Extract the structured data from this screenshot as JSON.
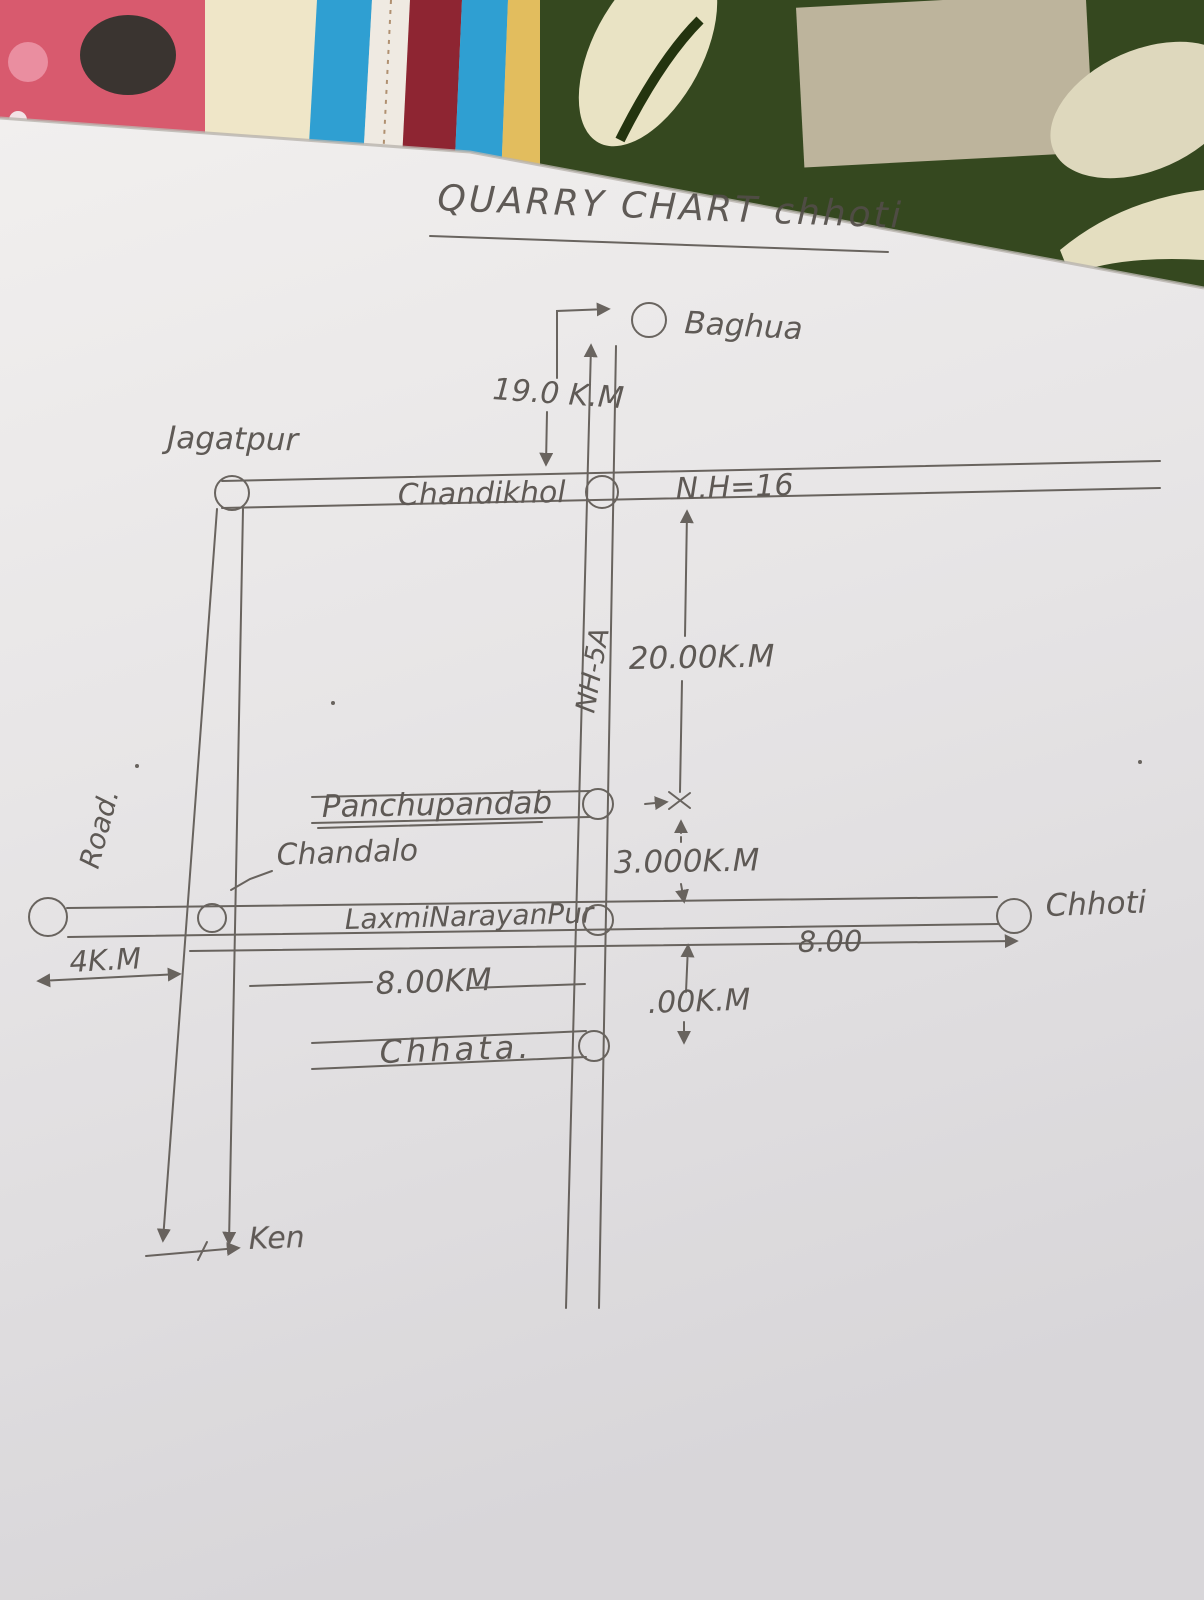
{
  "title": {
    "text": "QUARRY CHART chhoti"
  },
  "places": {
    "baghua": "Baghua",
    "jagatpur": "Jagatpur",
    "chandikhol": "Chandikhol",
    "panchupandab": "Panchupandab",
    "chandalo": "Chandalo",
    "laxminarayanpur": "LaxmiNarayanPur",
    "chhata": "Chhata.",
    "chhoti": "Chhoti",
    "ken": "Ken"
  },
  "roads": {
    "nh16": "N.H=16",
    "nh5a": "NH-5A",
    "left_road": "Road."
  },
  "distances": {
    "baghua_to_chandikhol": "19.0 K.M",
    "chandikhol_to_panchupandab": "20.00K.M",
    "panchupandab_to_laxminarayanpur": "3.000K.M",
    "west_segment": "4K.M",
    "laxminarayanpur_segment": "8.00KM",
    "east_segment": "8.00",
    "below_junction": ".00K.M"
  },
  "colors": {
    "pencil": "#524d48",
    "paper_light": "#efedec",
    "paper_dark": "#d9d7da",
    "fabric_pink": "#d85a6e",
    "fabric_cream": "#efe6c8",
    "fabric_blue": "#2f9fd2",
    "fabric_white_stripe": "#efeae2",
    "fabric_maroon": "#8e2532",
    "fabric_yellow": "#e2bd5e",
    "fabric_green": "#35481f",
    "fabric_tan": "#bdb49c"
  }
}
